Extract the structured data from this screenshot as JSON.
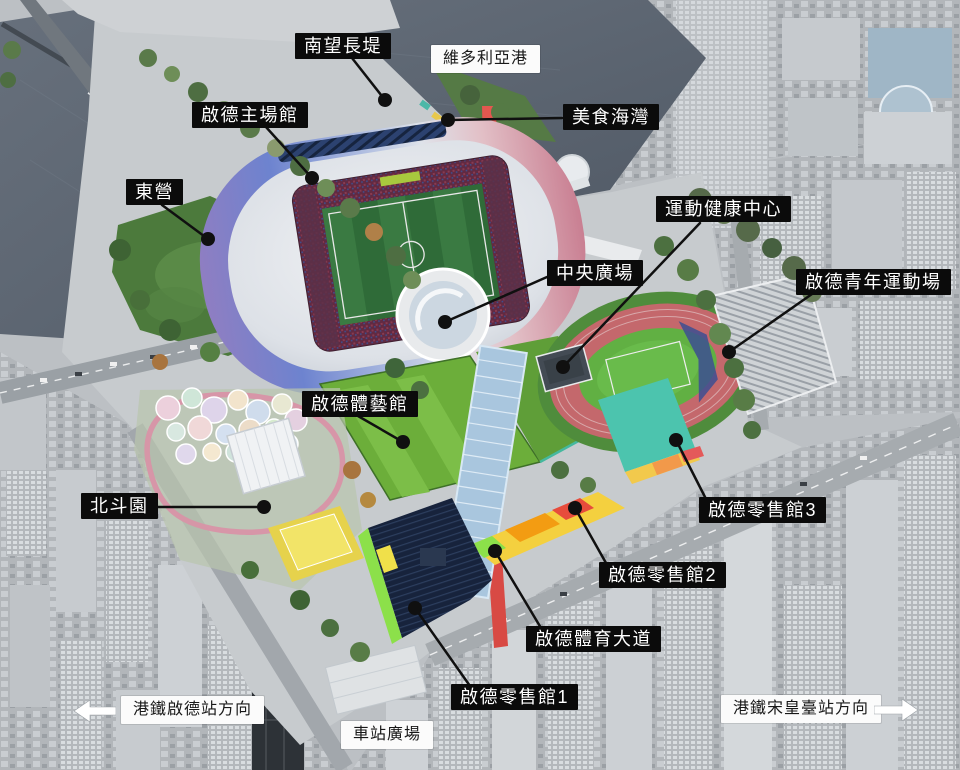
{
  "map_subject": "aerial rendering of Kai Tak Sports Park with Chinese facility labels",
  "labels": [
    {
      "id": "south-breakwater",
      "text": "南望長堤",
      "style": "dark"
    },
    {
      "id": "victoria-harbour",
      "text": "維多利亞港",
      "style": "light"
    },
    {
      "id": "kai-tak-main-stadium",
      "text": "啟德主場館",
      "style": "dark"
    },
    {
      "id": "food-bay",
      "text": "美食海灣",
      "style": "dark"
    },
    {
      "id": "east-camp-lawn",
      "text": "東營",
      "style": "dark"
    },
    {
      "id": "sports-health-centre",
      "text": "運動健康中心",
      "style": "dark"
    },
    {
      "id": "central-square",
      "text": "中央廣場",
      "style": "dark"
    },
    {
      "id": "kai-tak-youth-sports-ground",
      "text": "啟德青年運動場",
      "style": "dark"
    },
    {
      "id": "kai-tak-arena",
      "text": "啟德體藝館",
      "style": "dark"
    },
    {
      "id": "north-star-park",
      "text": "北斗園",
      "style": "dark"
    },
    {
      "id": "kai-tak-retail-hall-3",
      "text": "啟德零售館3",
      "style": "dark"
    },
    {
      "id": "kai-tak-retail-hall-2",
      "text": "啟德零售館2",
      "style": "dark"
    },
    {
      "id": "kai-tak-sports-avenue",
      "text": "啟德體育大道",
      "style": "dark"
    },
    {
      "id": "kai-tak-retail-hall-1",
      "text": "啟德零售館1",
      "style": "dark"
    },
    {
      "id": "mtr-kai-tak-station-direction",
      "text": "港鐵啟德站方向",
      "style": "light",
      "arrow": "left"
    },
    {
      "id": "station-square",
      "text": "車站廣場",
      "style": "light"
    },
    {
      "id": "mtr-sung-wong-toi-station-direction",
      "text": "港鐵宋皇臺站方向",
      "style": "light",
      "arrow": "right"
    }
  ],
  "colors": {
    "label_dark_bg": "#0b0b0b",
    "label_dark_text": "#ffffff",
    "label_light_bg": "#fbfbfb",
    "label_light_text": "#181818",
    "leader_line": "#101010",
    "harbour_water": "#5d6773",
    "stadium_shell_purple": "#8f7ec2",
    "stadium_shell_blue": "#6d83cf",
    "stadium_shell_pink": "#d9919b",
    "stadium_pitch_green": "#2f6b38",
    "running_track_pink": "#c4686c",
    "sports_field_green": "#61b043",
    "sports_avenue_red": "#e4574f",
    "glazed_canopy_blue": "#a9c6de",
    "solar_roof_navy": "#17233c",
    "retail_teal": "#4cc4ae",
    "city_grey": "#b2b6ba"
  }
}
